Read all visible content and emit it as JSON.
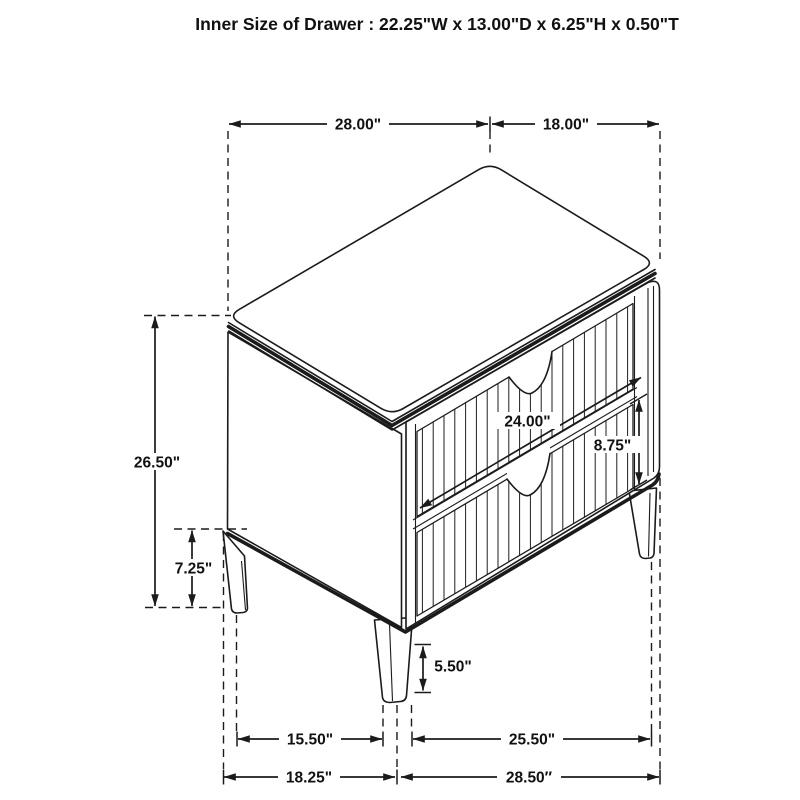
{
  "title": "Inner Size of Drawer : 22.25\"W x 13.00\"D x 6.25\"H x 0.50\"T",
  "colors": {
    "line": "#1b1b1b",
    "background": "#ffffff"
  },
  "dimensions": {
    "top_width": "28.00\"",
    "top_depth": "18.00\"",
    "overall_height": "26.50\"",
    "base_clearance": "7.25\"",
    "drawer_front_width": "24.00\"",
    "drawer_front_height": "8.75\"",
    "leg_height": "5.50\"",
    "leg_span_side": "15.50\"",
    "leg_span_front": "25.50\"",
    "base_width_side": "18.25\"",
    "base_width_front": "28.50″"
  }
}
